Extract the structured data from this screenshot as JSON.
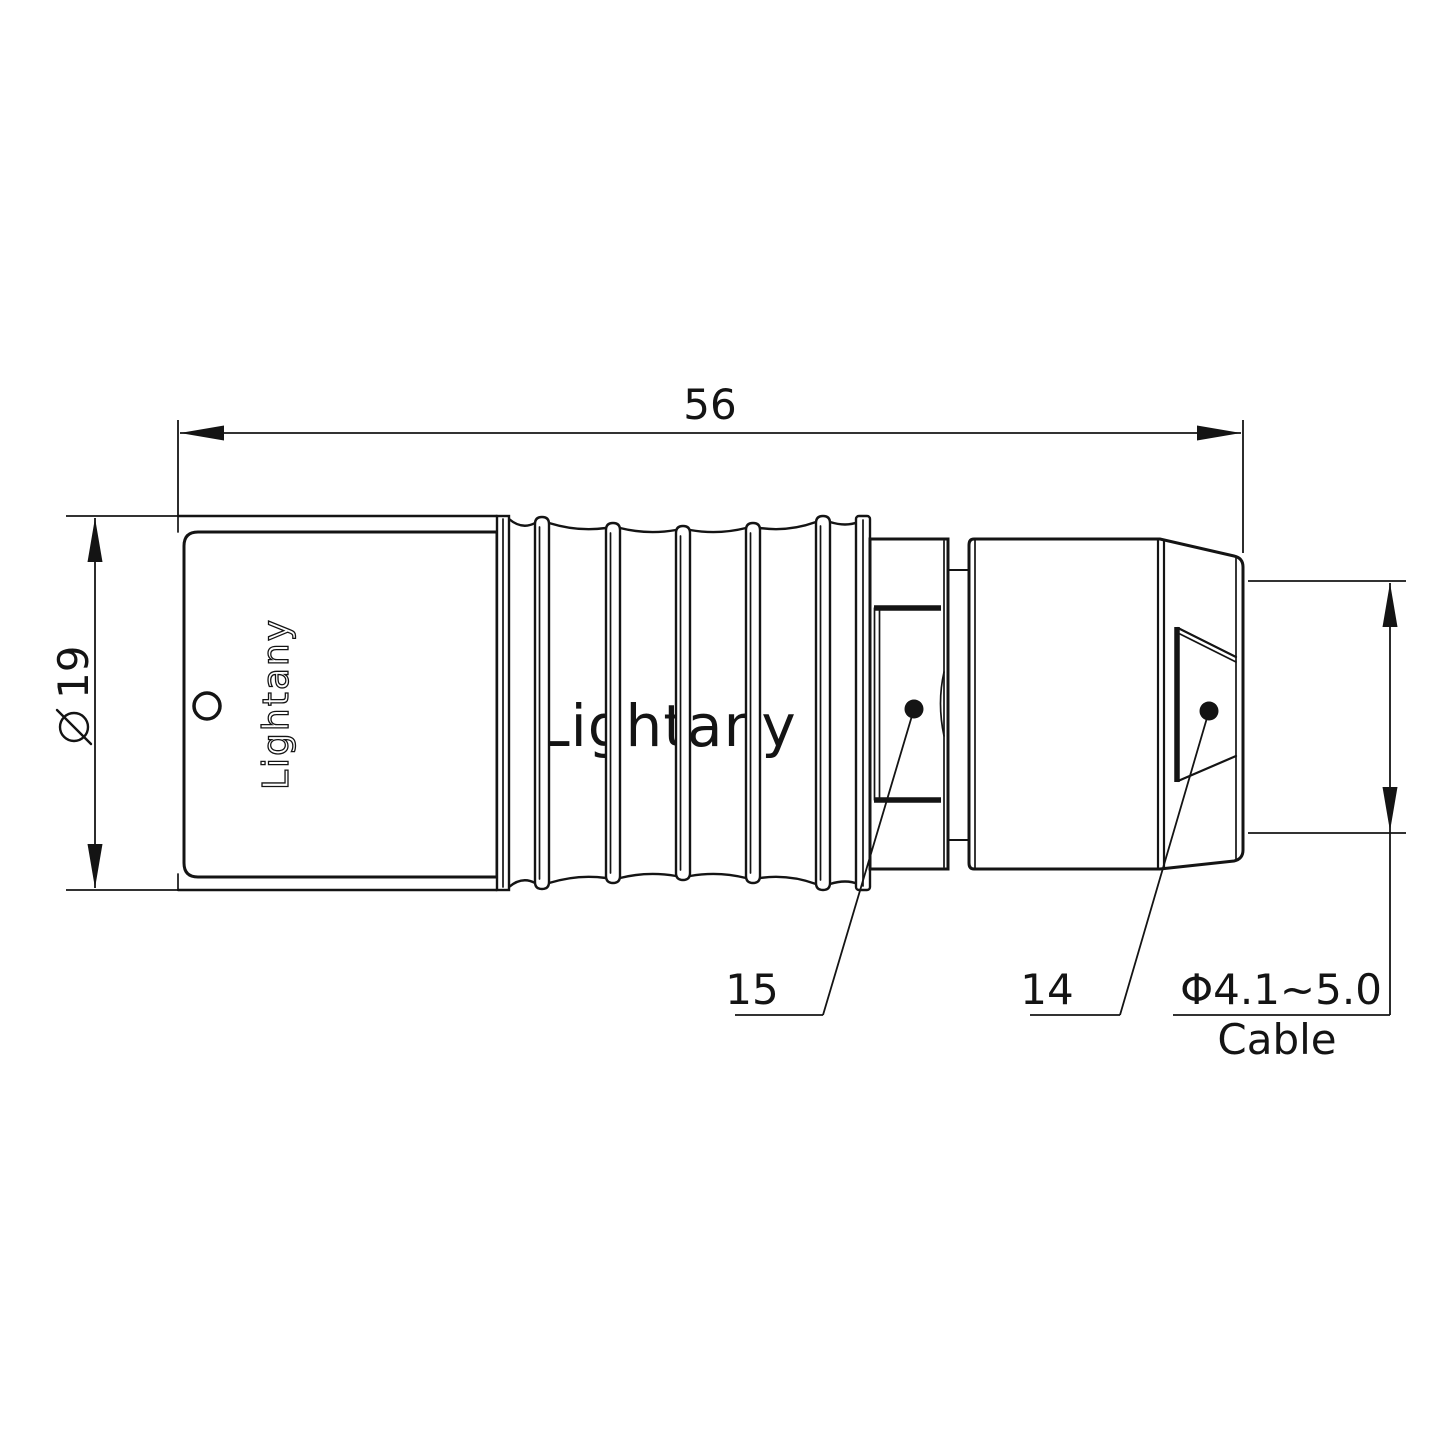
{
  "drawing": {
    "watermark_text": "Lightany",
    "engraving_text": "Lightany",
    "dim_overall_length": "56",
    "dim_diameter_symbol": "⌀",
    "dim_diameter_value": "19",
    "dim_cable_range": "Φ4.1~5.0",
    "dim_cable_label": "Cable",
    "part_number_collet": "15",
    "part_number_backshell": "14"
  },
  "colors": {
    "line": "#141414",
    "watermark_pink": "#f2c5c5"
  }
}
